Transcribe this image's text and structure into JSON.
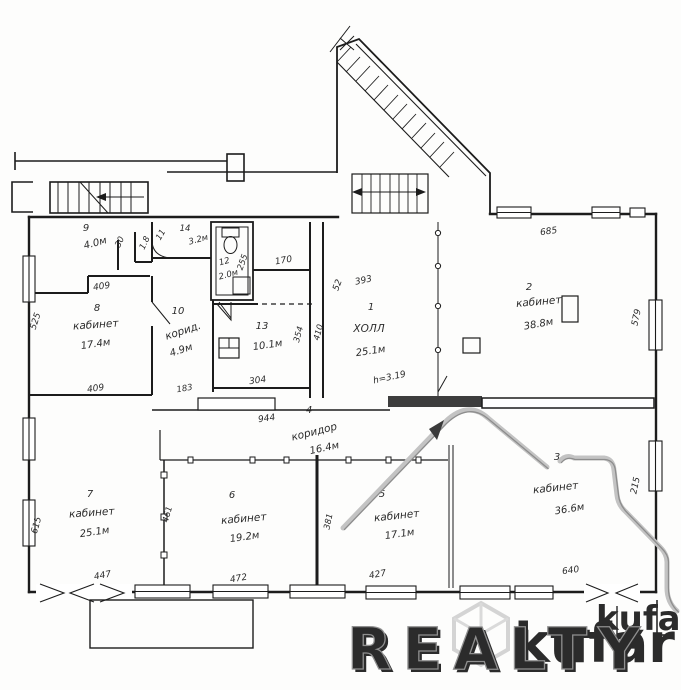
{
  "watermark": {
    "realty": "REALTY",
    "kufar": "kufar"
  },
  "plan": {
    "ceiling_note": "h=3.19",
    "rooms": [
      {
        "number": "1",
        "name": "ХОЛЛ",
        "area": "25.1м"
      },
      {
        "number": "2",
        "name": "кабинет",
        "area": "38.8м"
      },
      {
        "number": "3",
        "name": "кабинет",
        "area": "36.6м"
      },
      {
        "number": "4",
        "name": "коридор",
        "area": "16.4м"
      },
      {
        "number": "5",
        "name": "кабинет",
        "area": "17.1м"
      },
      {
        "number": "6",
        "name": "кабинет",
        "area": "19.2м"
      },
      {
        "number": "7",
        "name": "кабинет",
        "area": "25.1м"
      },
      {
        "number": "8",
        "name": "кабинет",
        "area": "17.4м"
      },
      {
        "number": "9",
        "name": "",
        "area": "4.0м"
      },
      {
        "number": "10",
        "name": "корид.",
        "area": "4.9м"
      },
      {
        "number": "11",
        "name": "",
        "area": "1.8"
      },
      {
        "number": "12",
        "name": "",
        "area": "2.0м"
      },
      {
        "number": "13",
        "name": "",
        "area": "10.1м"
      },
      {
        "number": "14",
        "name": "",
        "area": "3.2м"
      }
    ],
    "dimensions": {
      "top_right": "685",
      "right_upper": "579",
      "right_lower": "215",
      "left_upper": "525",
      "left_lower": "615",
      "bottom_1": "447",
      "bottom_2": "472",
      "bottom_3": "427",
      "bottom_4": "640",
      "room8_top": "409",
      "room8_bottom": "409",
      "room13_bottom": "304",
      "corridor_len": "944",
      "wc_side": "255",
      "hall_top": "393",
      "hall_side": "52",
      "vestibule": "170",
      "shaft_a": "354",
      "shaft_b": "410",
      "door_30": "30",
      "partition_183": "183",
      "partition_461": "461",
      "partition_381": "381"
    }
  }
}
